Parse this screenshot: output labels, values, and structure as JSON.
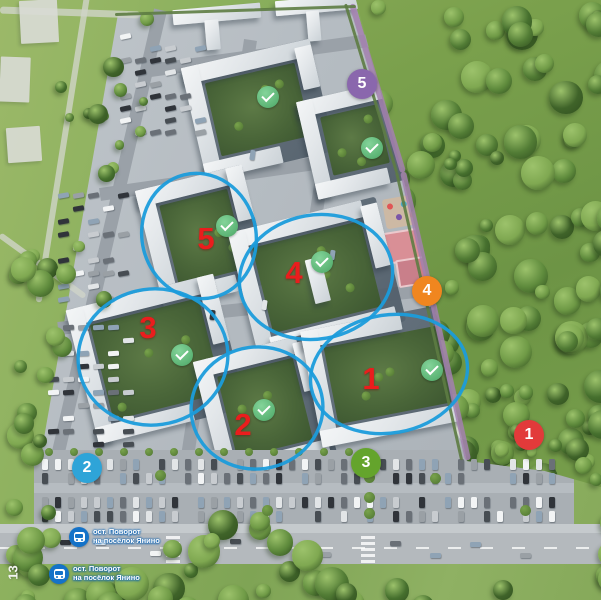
{
  "colors": {
    "highlight_ellipse": "#1b9cdb",
    "building_number": "#ea1d1d",
    "completed_check": "#5cb475",
    "poi_purple": "#8a67ad",
    "poi_orange": "#f0861f",
    "poi_red": "#e23a3a",
    "poi_green": "#64a42c",
    "poi_blue": "#2ea4d8",
    "bus_stop_blue": "#1472c8"
  },
  "overlay": {
    "check_icon": "checkmark",
    "building_highlights": [
      {
        "number": "5",
        "num_x": 206,
        "num_y": 239,
        "ellipse": {
          "cx": 199,
          "cy": 236,
          "rx": 57,
          "ry": 63,
          "rot": -14
        },
        "check": {
          "x": 227,
          "y": 226
        }
      },
      {
        "number": "4",
        "num_x": 294,
        "num_y": 273,
        "ellipse": {
          "cx": 316,
          "cy": 277,
          "rx": 77,
          "ry": 62,
          "rot": -10
        },
        "check": {
          "x": 322,
          "y": 262
        }
      },
      {
        "number": "3",
        "num_x": 148,
        "num_y": 328,
        "ellipse": {
          "cx": 153,
          "cy": 357,
          "rx": 75,
          "ry": 68,
          "rot": -8
        },
        "check": {
          "x": 182,
          "y": 355
        }
      },
      {
        "number": "2",
        "num_x": 243,
        "num_y": 425,
        "ellipse": {
          "cx": 257,
          "cy": 408,
          "rx": 66,
          "ry": 61,
          "rot": -8
        },
        "check": {
          "x": 264,
          "y": 410
        }
      },
      {
        "number": "1",
        "num_x": 371,
        "num_y": 379,
        "ellipse": {
          "cx": 389,
          "cy": 374,
          "rx": 79,
          "ry": 59,
          "rot": -10
        },
        "check": {
          "x": 432,
          "y": 370
        }
      }
    ],
    "extra_checks": [
      {
        "x": 268,
        "y": 97
      },
      {
        "x": 372,
        "y": 148
      }
    ],
    "poi_markers": [
      {
        "number": "5",
        "color_key": "poi_purple",
        "x": 362,
        "y": 84
      },
      {
        "number": "4",
        "color_key": "poi_orange",
        "x": 427,
        "y": 291
      },
      {
        "number": "1",
        "color_key": "poi_red",
        "x": 529,
        "y": 435
      },
      {
        "number": "3",
        "color_key": "poi_green",
        "x": 366,
        "y": 463
      },
      {
        "number": "2",
        "color_key": "poi_blue",
        "x": 87,
        "y": 468
      }
    ],
    "bus_stops": [
      {
        "line1": "ост. Поворот",
        "line2": "на посёлок Янино",
        "x": 79,
        "y": 537
      },
      {
        "line1": "ост. Поворот",
        "line2": "на посёлок Янино",
        "x": 59,
        "y": 574
      }
    ],
    "road_number": "13"
  }
}
